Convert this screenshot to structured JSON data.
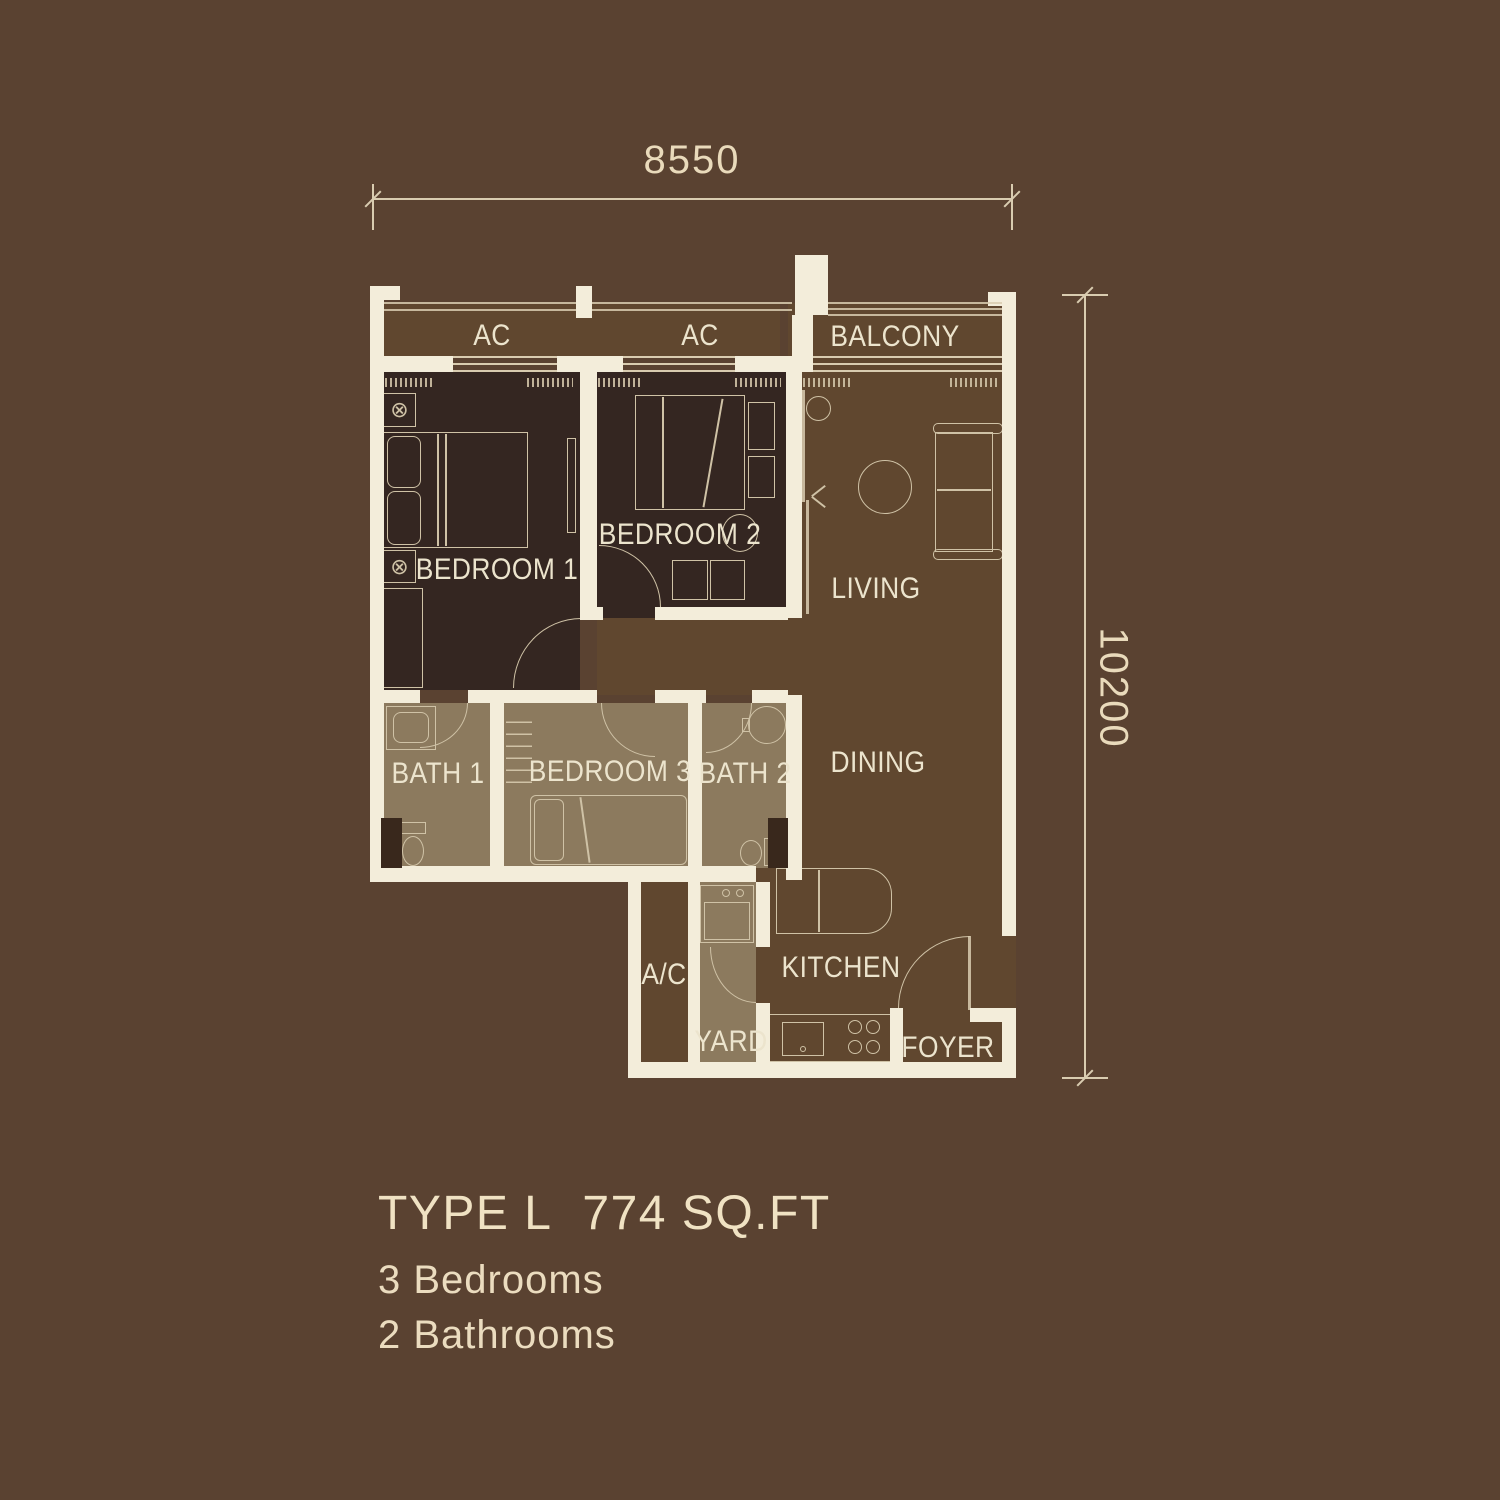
{
  "unit": {
    "type_label": "TYPE L",
    "area_label": "774 SQ.FT",
    "bedrooms": "3 Bedrooms",
    "bathrooms": "2 Bathrooms"
  },
  "dimensions": {
    "width_mm": "8550",
    "height_mm": "10200"
  },
  "rooms": {
    "ac_left": "AC",
    "ac_right": "AC",
    "balcony": "BALCONY",
    "bedroom1": "BEDROOM 1",
    "bedroom2": "BEDROOM 2",
    "living": "LIVING",
    "dining": "DINING",
    "bath1": "BATH 1",
    "bedroom3": "BEDROOM 3",
    "bath2": "BATH 2",
    "ac_ledge": "A/C",
    "kitchen": "KITCHEN",
    "yard": "YARD",
    "foyer": "FOYER"
  },
  "icons": {
    "fan_symbol": "⊗"
  },
  "colors": {
    "background": "#5a4231",
    "interior_floor": "#60472f",
    "bedroom_floor": "#342621",
    "bath_floor": "#8c7a5e",
    "wall": "#f3edda",
    "furniture_line": "#cfc2a6",
    "label_text": "#ece4cd",
    "dimension_text": "#e9dabb"
  }
}
